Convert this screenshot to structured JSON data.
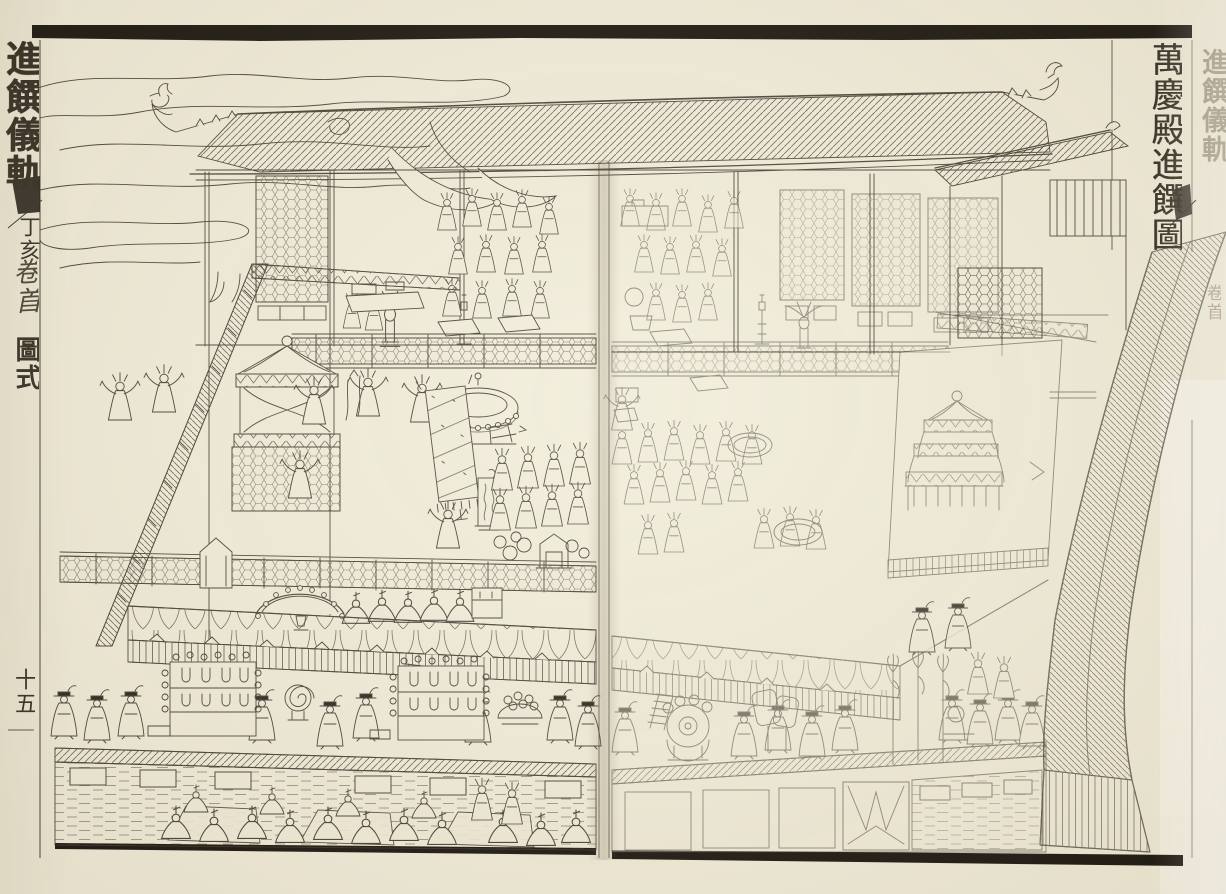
{
  "book": {
    "spine_title": "進饌儀軌",
    "cyclical_year": "丁亥",
    "volume_label": "卷首",
    "section_label": "圖式",
    "page_number": "十五"
  },
  "plate": {
    "caption": "萬慶殿進饌圖"
  },
  "adjacent_leaf": {
    "spine_title_partial": "進饌儀軌",
    "volume_label_partial": "卷首"
  },
  "colors": {
    "paper": "#f2edda",
    "ink": "#3a352b",
    "faint_ink": "#9c9383",
    "scan_black": "#19150f"
  }
}
